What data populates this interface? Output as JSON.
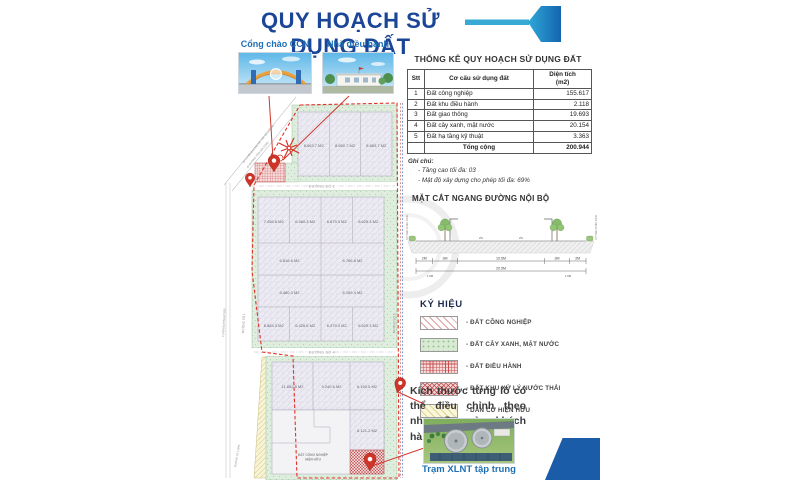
{
  "title": "QUY HOẠCH SỬ DỤNG ĐẤT",
  "photos": {
    "gate_label": "Cổng chào CCN",
    "admin_label": "Nhà điều hành",
    "plant_caption": "Trạm XLNT tập trung"
  },
  "stats": {
    "title": "THỐNG KÊ QUY HOẠCH SỬ DỤNG ĐẤT",
    "headers": {
      "no": "Stt",
      "category": "Cơ cấu sử dụng đất",
      "area": "Diện tích",
      "area_unit": "(m2)"
    },
    "rows": [
      {
        "no": "1",
        "category": "Đất công nghiệp",
        "area": "155.617"
      },
      {
        "no": "2",
        "category": "Đất khu điều hành",
        "area": "2.118"
      },
      {
        "no": "3",
        "category": "Đất giao thông",
        "area": "19.693"
      },
      {
        "no": "4",
        "category": "Đất cây xanh, mặt nước",
        "area": "20.154"
      },
      {
        "no": "5",
        "category": "Đất hạ tầng kỹ thuật",
        "area": "3.363"
      }
    ],
    "total_label": "Tổng cộng",
    "total": "200.944",
    "notes_title": "Ghi chú:",
    "notes": [
      "- Tầng cao tối đa: 03",
      "- Mật độ xây dựng cho phép tối đa: 69%"
    ]
  },
  "cross_section": {
    "title": "MẶT CẮT NGANG ĐƯỜNG NỘI BỘ",
    "dims": [
      "2M",
      "3M",
      "10.5M",
      "3M",
      "2M"
    ],
    "total": "20.5M",
    "offsets": [
      "1.5M",
      "1.5M"
    ],
    "slopes": [
      "2%",
      "2%"
    ],
    "post_label": "CỘT ĐÈN CHIẾU SÁNG"
  },
  "legend": {
    "title": "KÝ HIỆU",
    "items": [
      {
        "label": "- ĐẤT CÔNG NGHIỆP"
      },
      {
        "label": "- ĐẤT CÂY XANH, MẶT NƯỚC"
      },
      {
        "label": "- ĐẤT ĐIỀU HÀNH"
      },
      {
        "label": "- ĐẤT KHU XỬ LÝ NƯỚC THẢI"
      },
      {
        "label": "- DÂN CƯ HIỆN HỮU"
      }
    ]
  },
  "note": "Kích thước từng lô có thể điều chỉnh theo nhu cầu của khách hàng.",
  "map": {
    "roads": {
      "road1": "ĐƯỜNG SỐ 1",
      "road2": "ĐƯỜNG SỐ 2",
      "road3": "ĐƯỜNG SỐ 3",
      "road4": "ĐƯỜNG SỐ 4",
      "dt825": "TUYẾN ĐƯỜNG ĐT.825",
      "diag1": "ĐI TUYẾN ĐƯỜNG BỘ VEN SỐ 4 (T-06)",
      "diag2": "ĐI ĐƯỜNG TĨNH 826 (25M)",
      "alley": "ĐƯỜNG LÔ 2 (5M)"
    },
    "areas": {
      "residential1": "DÂN CƯ",
      "residential2": "HIỆN HỮU",
      "industrial1": "ĐẤT CÔNG NGHIỆP",
      "industrial2": "HIỆN HỮU"
    },
    "lots": [
      "8.663.7 M2",
      "8.650.7 M2",
      "8.663.7 M2",
      "7.456.6 M2",
      "6.460.3 M2",
      "6.679.3 M2",
      "6.629.3 M2",
      "6.816.6 M2",
      "6.766.8 M2",
      "6.480.3 M2",
      "6.159.4 M2",
      "6.884.3 M2",
      "6.426.6 M2",
      "6.479.3 M2",
      "6.629.3 M2",
      "11.652.8 M2",
      "9.240.6 M2",
      "6.150.5 M2",
      "6.121.2 M2"
    ]
  },
  "colors": {
    "title_blue": "#1B4596",
    "accent_cyan": "#2FA8D8",
    "flag_blue": "#1565AE",
    "label_blue": "#1F6FB5",
    "boundary_red": "#E03228",
    "pin_red": "#CE3427",
    "corner_blue": "#1A5CA8"
  }
}
